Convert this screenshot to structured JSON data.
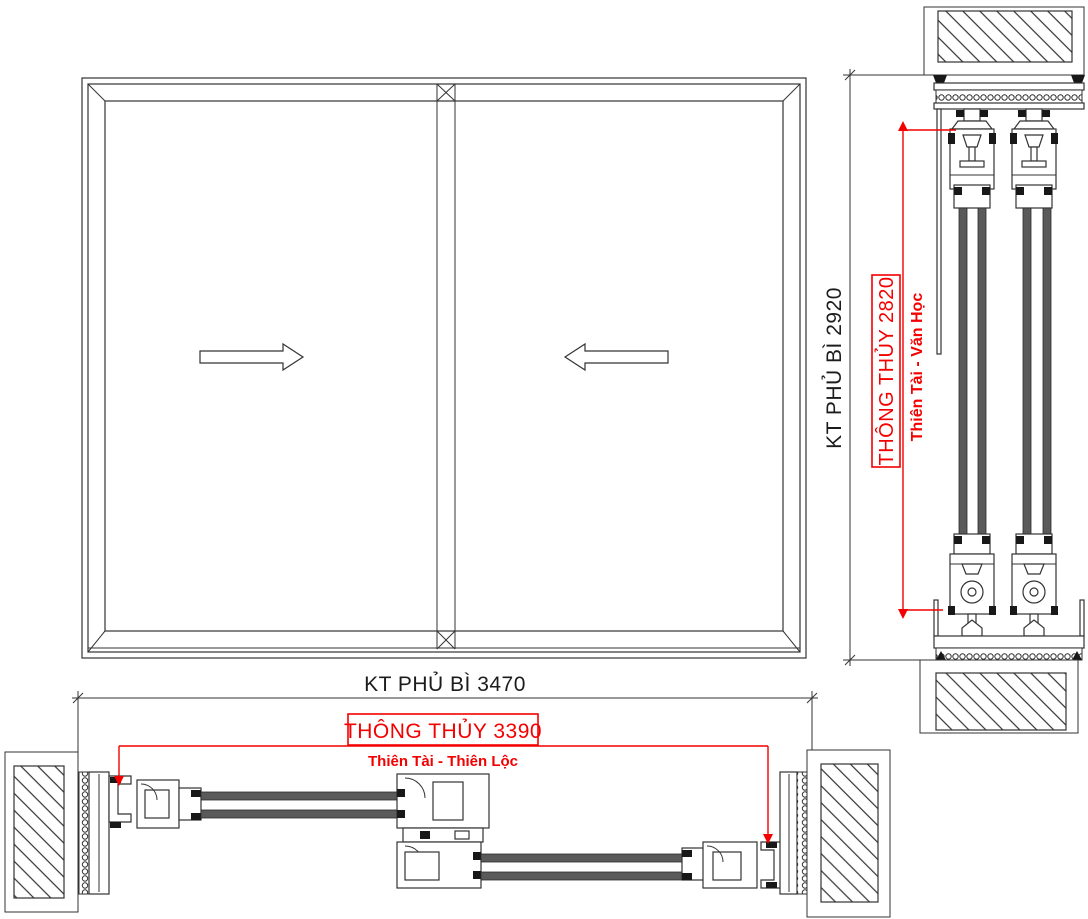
{
  "dimensions": {
    "width": {
      "overall_label": "KT PHỦ BÌ 3470",
      "overall_mm": 3470,
      "clear_label": "THÔNG THỦY 3390",
      "clear_mm": 3390,
      "fengshui_label": "Thiên Tài - Thiên Lộc"
    },
    "height": {
      "overall_label": "KT PHỦ BÌ 2920",
      "overall_mm": 2920,
      "clear_label": "THÔNG THỦY 2820",
      "clear_mm": 2820,
      "fengshui_label": "Thiên Tài - Văn Học"
    }
  },
  "elevation": {
    "panel_count": 2,
    "left_panel_arrow_icon": "arrow-right",
    "right_panel_arrow_icon": "arrow-left"
  },
  "colors": {
    "line": "#333333",
    "dimension_accent": "#f40000",
    "glass": "#5a5a5a",
    "background": "#ffffff"
  }
}
